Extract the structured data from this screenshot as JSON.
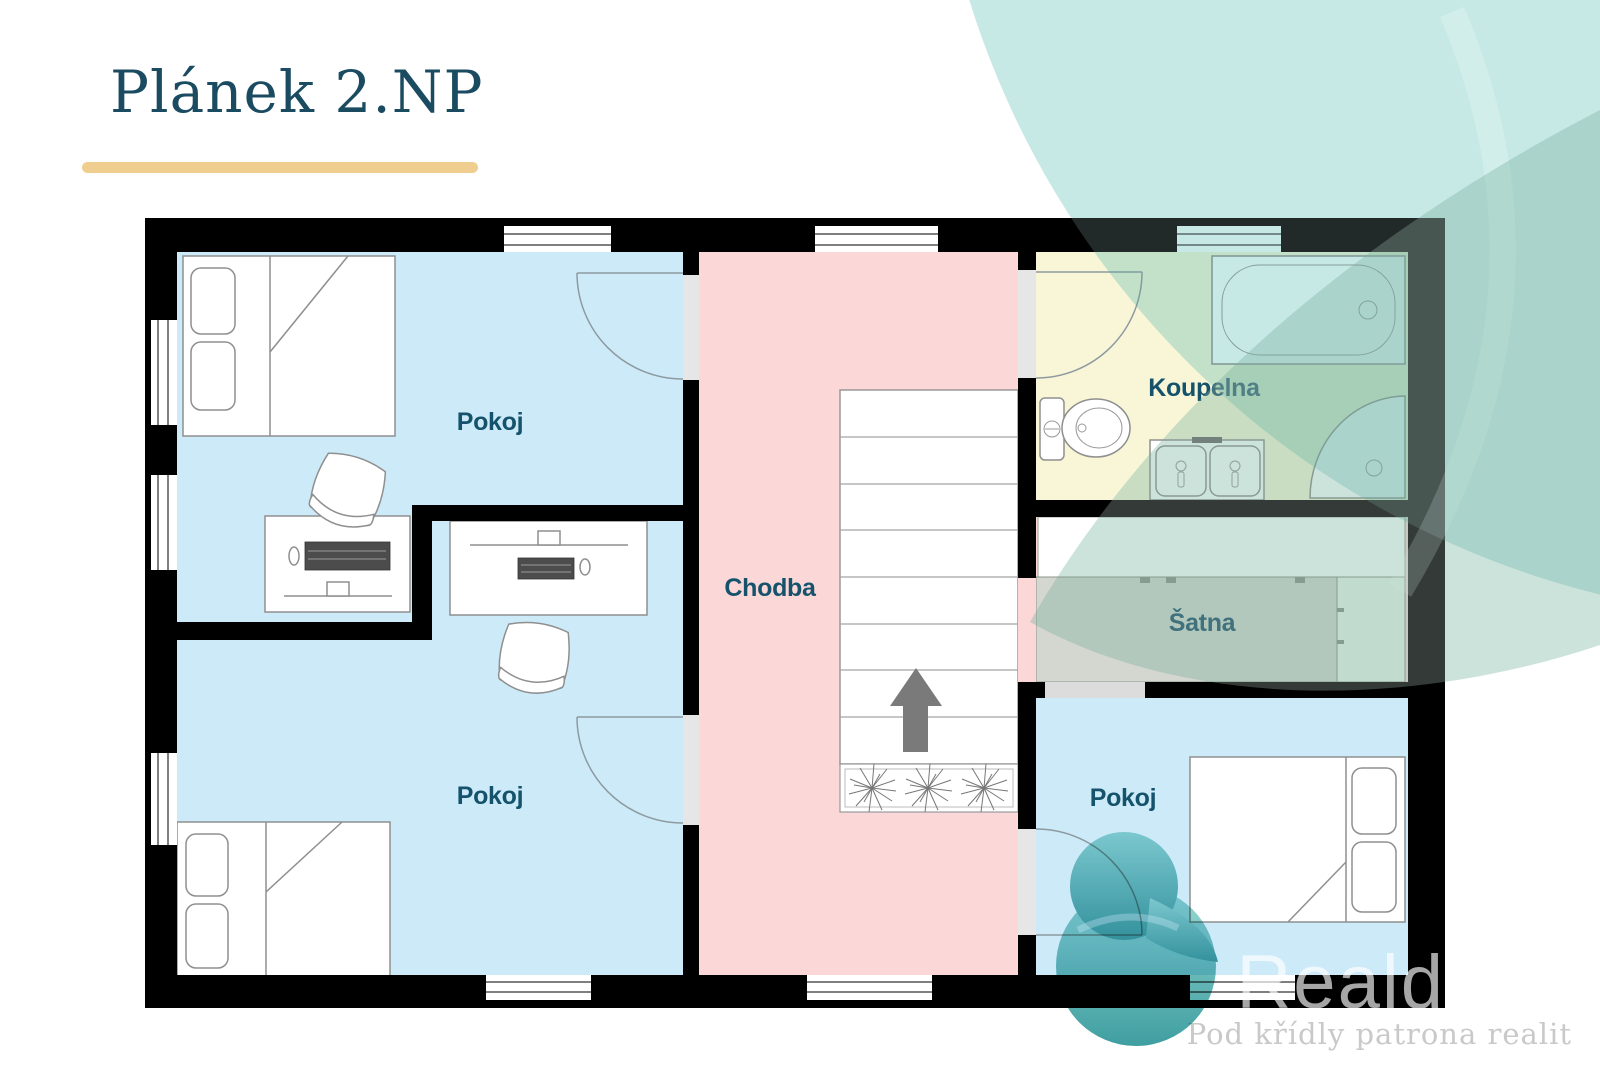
{
  "slide": {
    "title": "Plánek 2.NP"
  },
  "floorplan": {
    "rooms": [
      {
        "name": "pokoj-top-left",
        "label": "Pokoj"
      },
      {
        "name": "pokoj-bottom-left",
        "label": "Pokoj"
      },
      {
        "name": "chodba",
        "label": "Chodba"
      },
      {
        "name": "koupelna",
        "label": "Koupelna"
      },
      {
        "name": "satna",
        "label": "Šatna"
      },
      {
        "name": "pokoj-bottom-right",
        "label": "Pokoj"
      }
    ]
  },
  "watermark": {
    "brand": "Reald",
    "tagline": "Pod křídly patrona realit"
  },
  "colors": {
    "title": "#1b4b61",
    "accent_bar": "#efce8f",
    "room_label": "#14536b",
    "floor_blue": "#cdeaf9",
    "floor_pink": "#fbd7d8",
    "floor_yellow": "#f9f6d8",
    "wall": "#000000",
    "door_threshold": "#e6e6e6",
    "wardrobe_gray": "#d4d7cf",
    "decor_teal": "#c5e8e5",
    "logo_teal_dark": "#2a9496",
    "logo_teal_light": "#8fd6d0"
  }
}
